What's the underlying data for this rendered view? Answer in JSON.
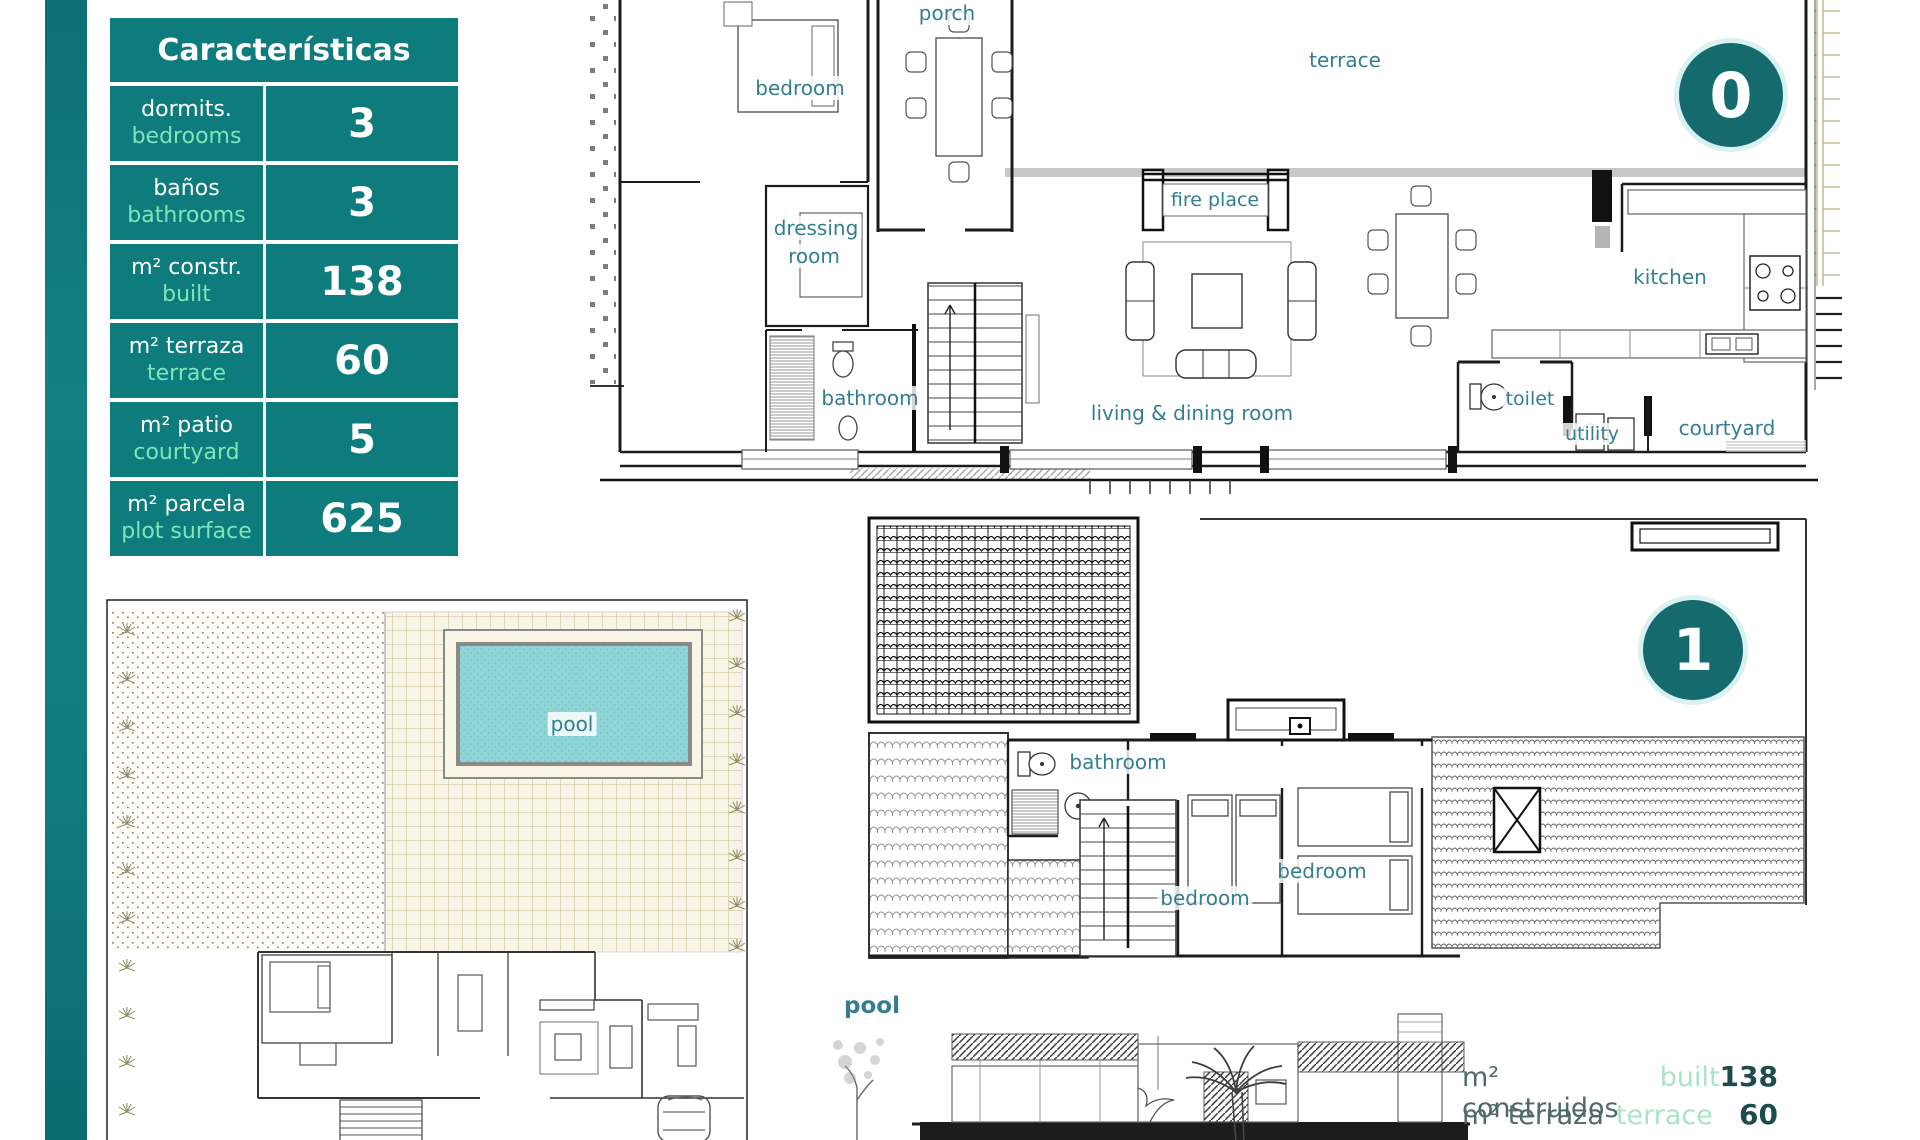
{
  "colors": {
    "teal": "#0e7b7d",
    "badge_teal": "#156a6e",
    "mint": "#7fe5b9",
    "label_teal": "#337f8f",
    "pool_fill": "#8fd5d6",
    "tan": "#cfc49e",
    "summary_dark": "#50696a",
    "summary_mint": "#a9e4c6",
    "summary_value": "#1d4b4e"
  },
  "table": {
    "title": "Características",
    "rows": [
      {
        "label_es": "dormits.",
        "label_en": "bedrooms",
        "value": "3"
      },
      {
        "label_es": "baños",
        "label_en": "bathrooms",
        "value": "3"
      },
      {
        "label_es": "m² constr.",
        "label_en": "built",
        "value": "138"
      },
      {
        "label_es": "m² terraza",
        "label_en": "terrace",
        "value": "60"
      },
      {
        "label_es": "m² patio",
        "label_en": "courtyard",
        "value": "5"
      },
      {
        "label_es": "m² parcela",
        "label_en": "plot surface",
        "value": "625"
      }
    ]
  },
  "floor0": {
    "badge": "0",
    "labels": {
      "porch": "porch",
      "bedroom": "bedroom",
      "terrace": "terrace",
      "dressing_line1": "dressing",
      "dressing_line2": "room",
      "bathroom": "bathroom",
      "fire_place": "fire place",
      "living_dining": "living & dining room",
      "kitchen": "kitchen",
      "toilet": "toilet",
      "utility": "utility",
      "courtyard": "courtyard"
    }
  },
  "floor1": {
    "badge": "1",
    "labels": {
      "bathroom": "bathroom",
      "bedroom_center": "bedroom",
      "bedroom_right": "bedroom",
      "pool": "pool"
    }
  },
  "site_plan": {
    "pool": "pool"
  },
  "summary": {
    "rows": [
      {
        "es": "m² construidos",
        "en": "built",
        "value": "138"
      },
      {
        "es": "m² terraza",
        "en": "terrace",
        "value": "60"
      }
    ]
  }
}
